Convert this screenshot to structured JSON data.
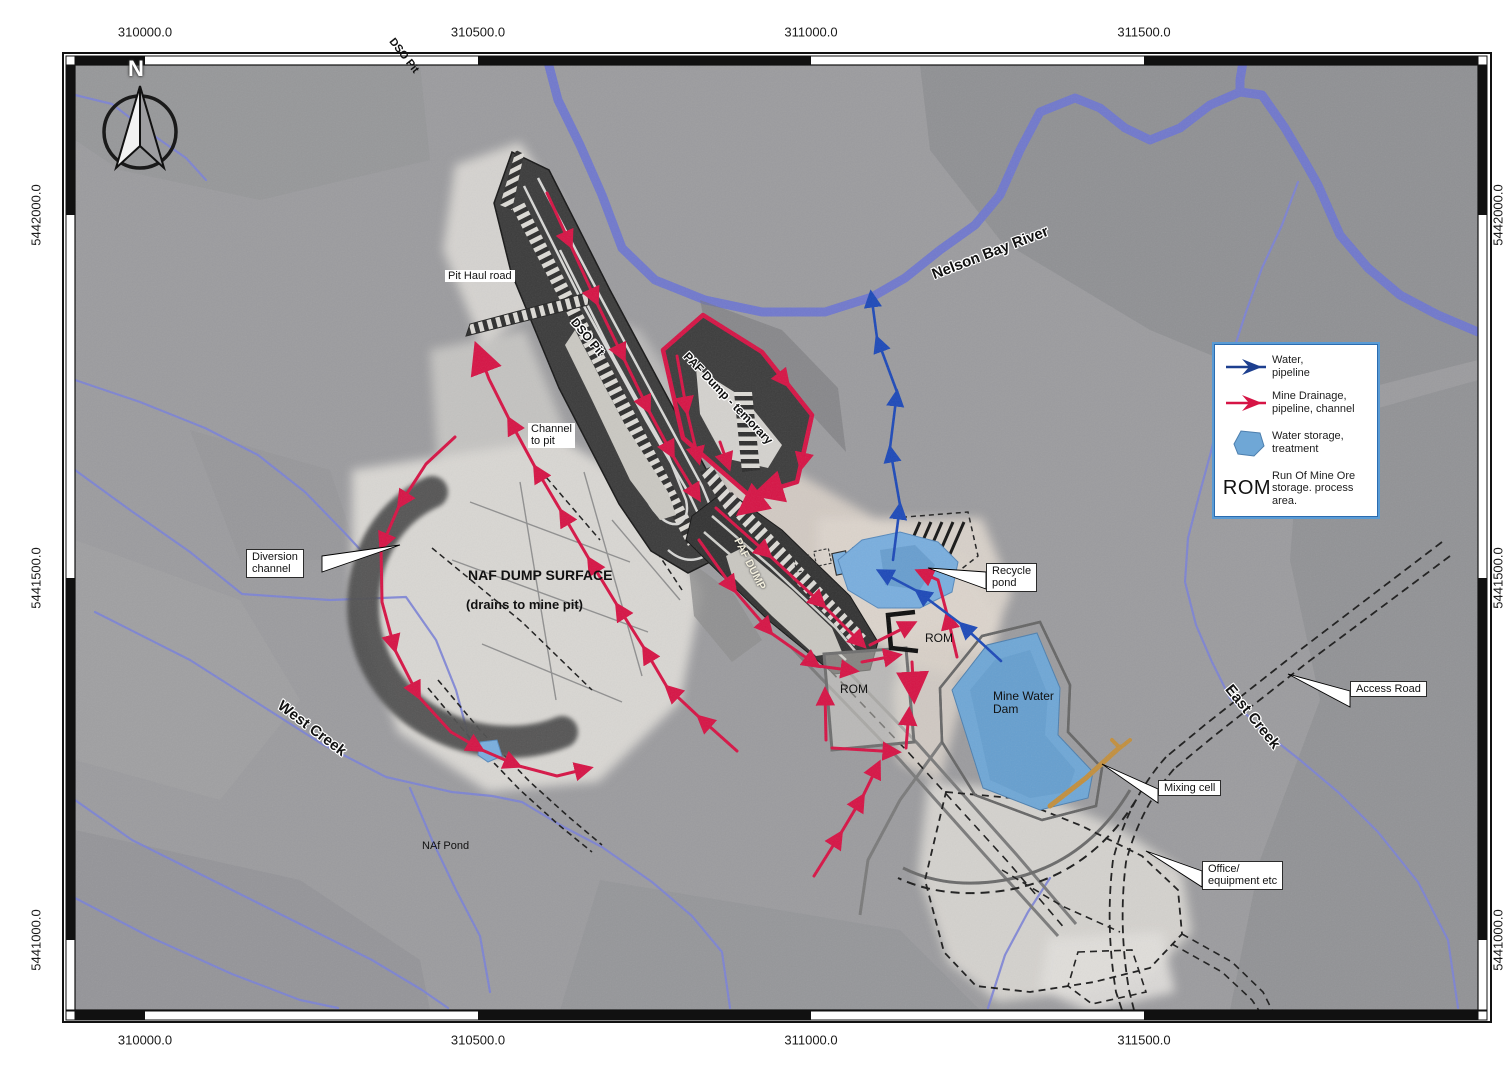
{
  "north_label": "N",
  "axes": {
    "top": [
      {
        "label": "310000.0",
        "pos": 145
      },
      {
        "label": "310500.0",
        "pos": 478
      },
      {
        "label": "311000.0",
        "pos": 811
      },
      {
        "label": "311500.0",
        "pos": 1144
      }
    ],
    "bottom": [
      {
        "label": "310000.0",
        "pos": 145
      },
      {
        "label": "310500.0",
        "pos": 478
      },
      {
        "label": "311000.0",
        "pos": 811
      },
      {
        "label": "311500.0",
        "pos": 1144
      }
    ],
    "left": [
      {
        "label": "5442000.0",
        "pos": 215
      },
      {
        "label": "5441500.0",
        "pos": 578
      },
      {
        "label": "5441000.0",
        "pos": 940
      }
    ],
    "right": [
      {
        "label": "5442000.0",
        "pos": 215
      },
      {
        "label": "5441500.0",
        "pos": 578
      },
      {
        "label": "5441000.0",
        "pos": 940
      }
    ]
  },
  "legend": {
    "items": [
      {
        "icon": "water-pipeline-arrow",
        "label": "Water,\npipeline"
      },
      {
        "icon": "mine-drainage-arrow",
        "label": "Mine Drainage,\npipeline, channel"
      },
      {
        "icon": "water-storage-polygon",
        "label": "Water storage,\ntreatment"
      },
      {
        "icon": "rom-text",
        "symbol": "ROM",
        "label": "Run Of Mine Ore\nstorage. process\narea."
      }
    ]
  },
  "colors": {
    "mine_drainage_red": "#d61445",
    "water_pipeline_blue": "#1d49b8",
    "water_fill": "#79aede",
    "river_blue": "#6f77cf"
  },
  "map_labels": [
    {
      "id": "dso-pit-top",
      "text": "DSO Pit",
      "x": 396,
      "y": 36,
      "rot": 52,
      "size": 11,
      "kind": "bold"
    },
    {
      "id": "pit-haul-road",
      "text": "Pit Haul road",
      "x": 445,
      "y": 270,
      "rot": 0,
      "size": 11,
      "kind": "whitebox"
    },
    {
      "id": "dso-pit-inner",
      "text": "DSO Pit",
      "x": 578,
      "y": 316,
      "rot": 50,
      "size": 12,
      "kind": "bold-halo"
    },
    {
      "id": "channel-to-pit",
      "text": "Channel\nto pit",
      "x": 528,
      "y": 423,
      "rot": 0,
      "size": 11,
      "kind": "whitebox"
    },
    {
      "id": "paf-dump-temporary",
      "text": "PAF Dump - temorary",
      "x": 690,
      "y": 350,
      "rot": 46,
      "size": 12,
      "kind": "bold-halo"
    },
    {
      "id": "paf-dump",
      "text": "PAF DUMP",
      "x": 742,
      "y": 536,
      "rot": 63,
      "size": 11,
      "kind": "light"
    },
    {
      "id": "naf-dump-title",
      "text": "NAF DUMP SURFACE",
      "x": 468,
      "y": 568,
      "rot": 0,
      "size": 14,
      "kind": "bold"
    },
    {
      "id": "naf-dump-sub",
      "text": "(drains to mine pit)",
      "x": 466,
      "y": 598,
      "rot": 0,
      "size": 13,
      "kind": "bold"
    },
    {
      "id": "diversion-channel",
      "text": "Diversion\nchannel",
      "x": 246,
      "y": 549,
      "rot": 0,
      "size": 11,
      "kind": "callout"
    },
    {
      "id": "recycle-pond",
      "text": "Recycle\npond",
      "x": 986,
      "y": 563,
      "rot": 0,
      "size": 11,
      "kind": "callout"
    },
    {
      "id": "rom-upper",
      "text": "ROM",
      "x": 925,
      "y": 632,
      "rot": 0,
      "size": 12,
      "kind": "plain"
    },
    {
      "id": "rom-lower",
      "text": "ROM",
      "x": 840,
      "y": 683,
      "rot": 0,
      "size": 12,
      "kind": "plain"
    },
    {
      "id": "mine-water-dam",
      "text": "Mine Water\nDam",
      "x": 993,
      "y": 690,
      "rot": 0,
      "size": 12,
      "kind": "plain"
    },
    {
      "id": "nelson-bay-river",
      "text": "Nelson Bay River",
      "x": 930,
      "y": 268,
      "rot": -21,
      "size": 15,
      "kind": "halo"
    },
    {
      "id": "west-creek",
      "text": "West Creek",
      "x": 284,
      "y": 698,
      "rot": 37,
      "size": 15,
      "kind": "halo"
    },
    {
      "id": "east-creek",
      "text": "East Creek",
      "x": 1234,
      "y": 682,
      "rot": 51,
      "size": 15,
      "kind": "halo"
    },
    {
      "id": "access-road",
      "text": "Access Road",
      "x": 1350,
      "y": 681,
      "rot": 0,
      "size": 11,
      "kind": "callout"
    },
    {
      "id": "mixing-cell",
      "text": "Mixing cell",
      "x": 1158,
      "y": 780,
      "rot": 0,
      "size": 11,
      "kind": "callout"
    },
    {
      "id": "office-equipment",
      "text": "Office/\nequipment etc",
      "x": 1202,
      "y": 861,
      "rot": 0,
      "size": 11,
      "kind": "callout"
    },
    {
      "id": "naf-pond",
      "text": "NAf Pond",
      "x": 422,
      "y": 840,
      "rot": 0,
      "size": 11,
      "kind": "plain"
    }
  ]
}
